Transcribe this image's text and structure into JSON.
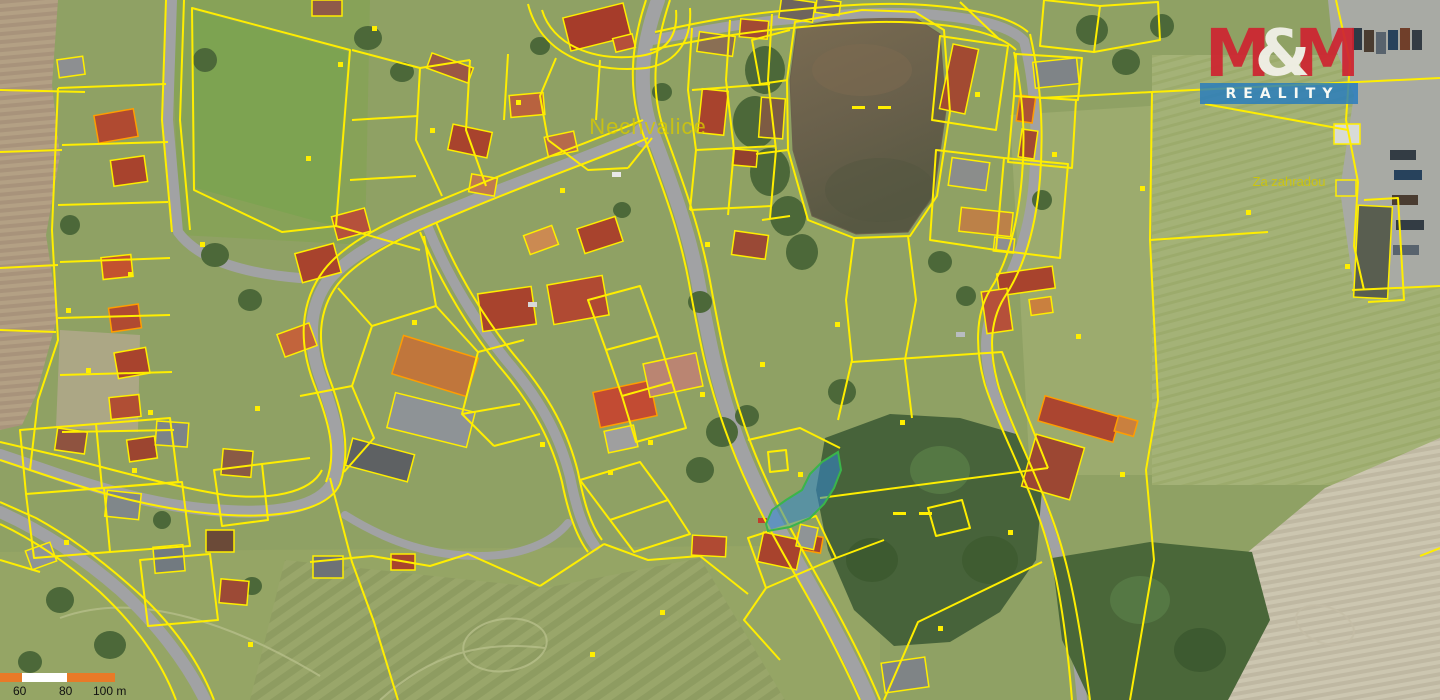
{
  "labels": {
    "place": "Nechvalice",
    "field_name": "Za zahradou"
  },
  "logo": {
    "m_left": "M",
    "ampersand": "&",
    "m_right": "M",
    "subtitle": "REALITY"
  },
  "logo_colors": {
    "red": "#cf2330",
    "blue": "#237bc0",
    "white": "#f5f2ec"
  },
  "scalebar": {
    "tick_60": "60",
    "tick_80": "80",
    "tick_100": "100 m",
    "segment_colors": [
      "#e87a28",
      "#ffffff",
      "#e87a28"
    ]
  },
  "map": {
    "colors": {
      "parcel_line": "#ffee00",
      "building_outline_highlight": "#ff9d00",
      "selected_parcel_fill": "#2f86d4",
      "selected_parcel_stroke": "#3ab54a",
      "pond_water": "#6b604d",
      "road": "#a1a2a4",
      "forest": "#47633a",
      "grass": "#8fa164",
      "plowed_field": "#b3a084",
      "stubble_field": "#c9c3ac"
    },
    "markers": [
      [
        306,
        156
      ],
      [
        86,
        368
      ],
      [
        128,
        272
      ],
      [
        148,
        410
      ],
      [
        255,
        406
      ],
      [
        338,
        62
      ],
      [
        372,
        26
      ],
      [
        430,
        128
      ],
      [
        516,
        100
      ],
      [
        560,
        188
      ],
      [
        540,
        442
      ],
      [
        608,
        470
      ],
      [
        648,
        440
      ],
      [
        700,
        392
      ],
      [
        760,
        362
      ],
      [
        798,
        472
      ],
      [
        900,
        420
      ],
      [
        938,
        626
      ],
      [
        975,
        92
      ],
      [
        1052,
        152
      ],
      [
        1076,
        334
      ],
      [
        1120,
        472
      ],
      [
        1140,
        186
      ],
      [
        1246,
        210
      ],
      [
        1345,
        264
      ],
      [
        660,
        610
      ],
      [
        590,
        652
      ],
      [
        248,
        642
      ],
      [
        66,
        308
      ],
      [
        200,
        242
      ],
      [
        412,
        320
      ],
      [
        705,
        242
      ],
      [
        835,
        322
      ],
      [
        1008,
        530
      ],
      [
        132,
        468
      ],
      [
        64,
        540
      ]
    ],
    "water_dashes": [
      [
        852,
        106
      ],
      [
        878,
        106
      ],
      [
        893,
        512
      ],
      [
        919,
        512
      ]
    ]
  }
}
